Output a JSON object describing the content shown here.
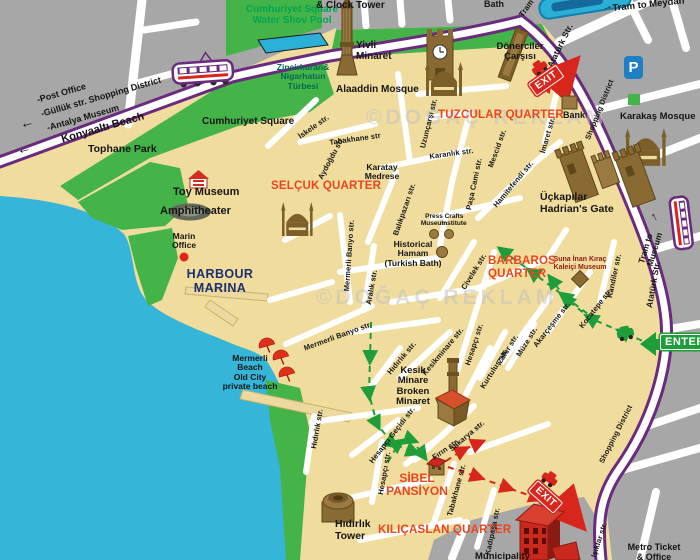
{
  "watermark": "©DOĞAÇ REKLAM",
  "colors": {
    "sea": "#35b5d8",
    "land": "#f0dc9c",
    "street": "#ffffff",
    "block_gray": "#a7a7a7",
    "park_green": "#44b449",
    "road_purple": "#6a2a7e",
    "quarter_red": "#e8461f",
    "exit_red": "#d9261c",
    "enter_green": "#1f9d3a",
    "parking_blue": "#1f7fc4",
    "icon_brown": "#8a6a33",
    "route_green": "#1f9d3a",
    "route_red": "#d9261c"
  },
  "icons": {
    "left_arrow": "←",
    "up_arrow": "↑",
    "ne_arrow": "→"
  },
  "signs": {
    "enter": "ENTER",
    "exit": "EXIT",
    "parking": "P"
  },
  "directions": {
    "post_office": "-Post Office",
    "gulluk": "-Güllük str. Shopping District",
    "antalya_museum": "-Antalya Museum",
    "konyaalti": "Konyaaltı Beach",
    "tram_to_meydan": "Tram to Meydan",
    "tram_to_museum": "Tram to Museum",
    "tram": "Tram"
  },
  "quarters": {
    "tuzcular": "TUZCULAR QUARTER",
    "selcuk": "SELÇUK QUARTER",
    "barbaros": "BARBAROS\nQUARTER",
    "kilicaslan": "KILIÇASLAN QUARTER"
  },
  "places": {
    "cumhuriyet_pool": "Cumhuriyet Square\nWater Shov Pool",
    "cumhuriyet_square": "Cumhuriyet Square",
    "tophane_park": "Tophane Park",
    "yivli": "Yivli\nMinaret",
    "zincirkiran": "Zincirkuran&\nNigarhatun\nTürbesi",
    "alaaddin": "Alaaddin Mosque",
    "clock_tower": "& Clock Tower",
    "bath": "Bath",
    "donerciler": "Dönerciler\nÇarşısı",
    "bank": "Bank",
    "karakas": "Karakaş Mosque",
    "toy_museum": "Toy Museum",
    "amphitheater": "Amphitheater",
    "marin_office": "Marin\nOffice",
    "harbour_marina": "HARBOUR\nMARINA",
    "karatay": "Karatay\nMedrese",
    "press_museum": "Press\nMuseum",
    "crafts_institute": "Crafts\nInstitute",
    "hamam": "Historical\nHamam\n(Turkish Bath)",
    "hadrians_gate": "Üçkapılar\nHadrian's Gate",
    "suna_museum": "Suna İnan Kıraç\nKaleiçi Museum",
    "mermerli_beach": "Mermerli\nBeach\nOld City\nprivate beach",
    "kesik_minare": "Kesik\nMinare\nBroken\nMinaret",
    "sibel": "SİBEL\nPANSİYON",
    "hidirlik_tower": "Hıdırlık\nTower",
    "metro_ticket": "Metro Ticket\n& Office",
    "municipality": "Municipality"
  },
  "streets": {
    "iskele": "İskele str.",
    "tabakhane_n": "Tabakhane str",
    "aydogdu": "Aydoğdu str.",
    "uzuncarsi": "Uzunçarşı str.",
    "karanlik": "Karanlık str.",
    "mescid": "Mescid str.",
    "pasa_cami": "Paşa Cami str.",
    "hamitefendi": "Hamitefendi str.",
    "imaret": "İmaret str.",
    "balikpazari": "Balıkpazarı str.",
    "mermerli_banyo_a": "Mermerli Banyo str.",
    "mermerli_banyo_b": "Mermerli Banyo str.",
    "aralik": "Aralık str.",
    "civelek": "Civelek str.",
    "kocatepe": "Kocatepe str.",
    "kandiler": "Kandiler str.",
    "ataturk_n": "Atatürk Str.",
    "ataturk_s": "Atatürk Str.",
    "shopping_n": "Shopping District",
    "shopping_s": "Shopping District",
    "akarcesme": "Akarçeşme str.",
    "muze": "Müze str.",
    "zafer": "Zafer str.",
    "kurtulus": "Kurtuluş str.",
    "kesikminare": "Kesikminare str.",
    "hesapci_a": "Hesapçı str.",
    "hesapci_b": "Hesapçı str.",
    "hesapci_gecidi": "Hesapçı Geçidi str.",
    "hidirlik_a": "Hıdırlık str.",
    "hidirlik_b": "Hıdırlık str.",
    "sakarya": "Sakarya str.",
    "firin": "Fırın str.",
    "tabakhane_s": "Tabakhane str.",
    "kadipasa": "Kadıpaşa str.",
    "isiklar": "Işıklar str."
  }
}
